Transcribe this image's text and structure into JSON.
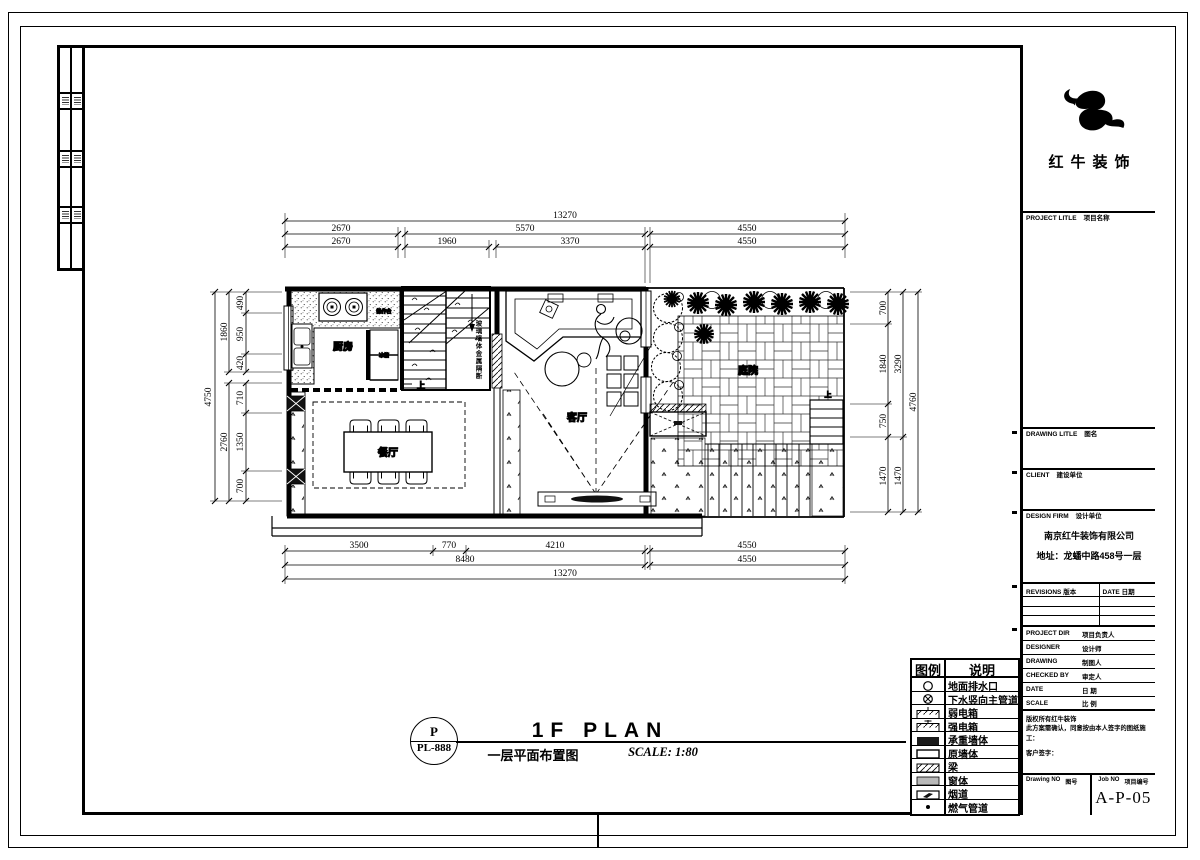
{
  "brand": {
    "name": "红牛装饰"
  },
  "title_block": {
    "project": {
      "en": "PROJECT LITLE",
      "cn": "项目名称"
    },
    "drawing_title": {
      "en": "DRAWING LITLE",
      "cn": "图名"
    },
    "client": {
      "en": "CLIENT",
      "cn": "建设单位"
    },
    "design_firm": {
      "en": "DESIGN FIRM",
      "cn": "设计单位"
    },
    "firm_name": "南京红牛装饰有限公司",
    "firm_address": "地址：龙蟠中路458号一层",
    "revisions_en": "REVISIONS",
    "revisions_cn": "版本",
    "date_en": "DATE",
    "date_cn": "日期",
    "rows": [
      {
        "en": "PROJECT DIR",
        "cn": "项目负责人"
      },
      {
        "en": "DESIGNER",
        "cn": "设计师"
      },
      {
        "en": "DRAWING",
        "cn": "制图人"
      },
      {
        "en": "CHECKED BY",
        "cn": "审定人"
      },
      {
        "en": "DATE",
        "cn": "日 期"
      },
      {
        "en": "SCALE",
        "cn": "比 例"
      }
    ],
    "notes": [
      "版权所有红牛装饰",
      "此方案需确认，同意按由本人签字的图纸施工：",
      "客户签字："
    ],
    "drawing_no_en": "Drawing NO",
    "drawing_no_cn": "图号",
    "job_no_en": "Job NO",
    "job_no_cn": "项目编号",
    "sheet_number": "A-P-05"
  },
  "legend": {
    "header": {
      "symbol": "图例",
      "desc": "说明"
    },
    "items": [
      {
        "icon": "drain-circle",
        "label": "地面排水口"
      },
      {
        "icon": "sewer-riser",
        "label": "下水竖向主管道"
      },
      {
        "icon": "weak-power-box",
        "label": "弱电箱"
      },
      {
        "icon": "strong-power-box",
        "label": "强电箱"
      },
      {
        "icon": "bearing-wall",
        "label": "承重墙体"
      },
      {
        "icon": "original-wall",
        "label": "原墙体"
      },
      {
        "icon": "beam",
        "label": "梁"
      },
      {
        "icon": "window",
        "label": "窗体"
      },
      {
        "icon": "flue",
        "label": "烟道"
      },
      {
        "icon": "gas-pipe",
        "label": "燃气管道"
      }
    ]
  },
  "sheet_title": {
    "bubble_top": "P",
    "bubble_no": "PL-888",
    "title": "1F PLAN",
    "subtitle": "一层平面布置图",
    "scale": "SCALE: 1:80"
  },
  "plan": {
    "rooms": {
      "kitchen": "厨房",
      "dining": "餐厅",
      "living": "客厅",
      "courtyard": "庭院"
    },
    "labels": {
      "up": "上",
      "stair_note": "玻璃墙体金属隔断",
      "counter": "操作台",
      "fridge": "冰箱"
    },
    "dims": {
      "top": {
        "total": "13270",
        "row2": [
          "2670",
          "5570",
          "4550"
        ],
        "row3": [
          "2670",
          "1960",
          "3370",
          "4550"
        ]
      },
      "bottom": {
        "row1": [
          "3500",
          "770",
          "4210",
          "4550"
        ],
        "row2": [
          "8480",
          "4550"
        ],
        "total": "13270"
      },
      "left": {
        "total": "4750",
        "mid": [
          "1860",
          "2760"
        ],
        "inner": [
          "490",
          "950",
          "420",
          "710",
          "1350",
          "700"
        ]
      },
      "right": {
        "inner": [
          "700",
          "1840",
          "750",
          "1470"
        ],
        "mid": [
          "3290",
          "1470"
        ],
        "total": "4760"
      }
    }
  }
}
